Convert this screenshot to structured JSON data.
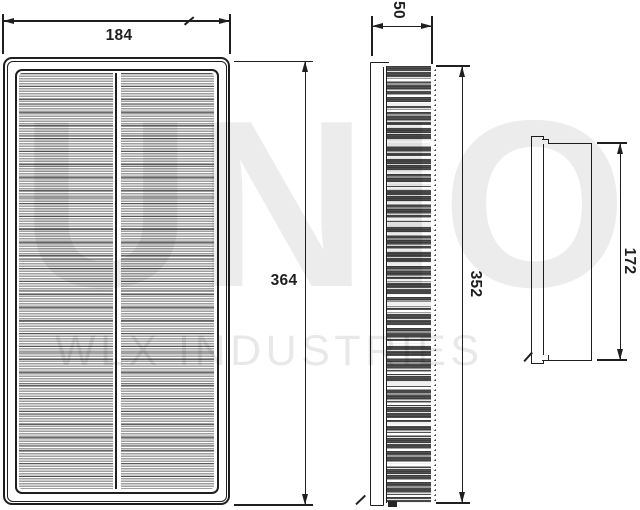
{
  "dimensions": {
    "front_width": "184",
    "front_height": "364",
    "side_depth": "50",
    "side_height": "352",
    "end_height": "172"
  },
  "watermark": {
    "brand": "UNIO",
    "subtitle": "WLX INDUSTRIES"
  },
  "colors": {
    "line": "#1f1f1f",
    "pleat_media_dark": "#454545",
    "pleat_media_light": "#9e9e9e",
    "background": "#ffffff"
  }
}
